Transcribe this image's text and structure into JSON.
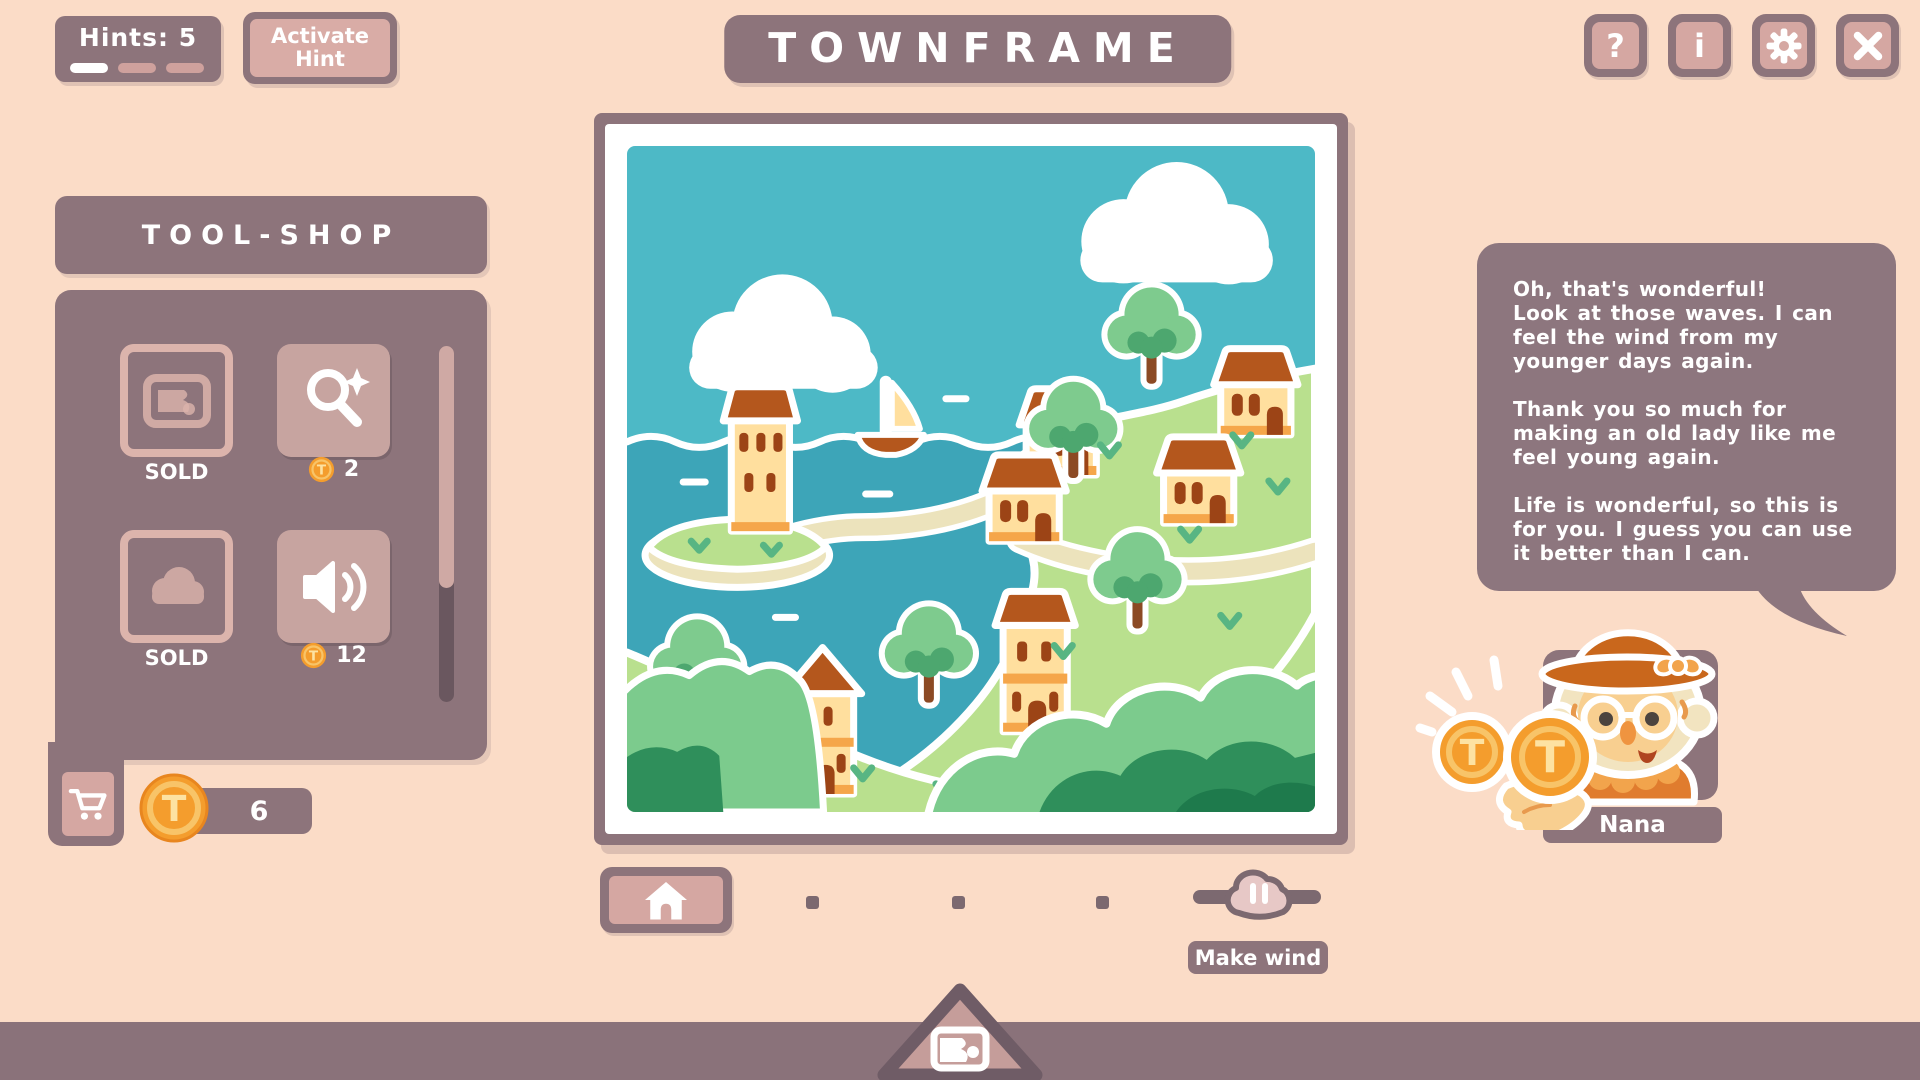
{
  "header": {
    "hints_label": "Hints: 5",
    "hint_meter": {
      "total": 3,
      "filled": 1
    },
    "activate_hint_label": "Activate Hint",
    "title": "TOWNFRAME",
    "help_glyph": "?",
    "info_glyph": "i"
  },
  "shop": {
    "title": "TOOL-SHOP",
    "currency_glyph": "T",
    "items": [
      {
        "id": "picture",
        "status": "SOLD"
      },
      {
        "id": "magnifier",
        "price": "2"
      },
      {
        "id": "cloud",
        "status": "SOLD"
      },
      {
        "id": "speaker",
        "price": "12"
      }
    ],
    "coin_balance": "6"
  },
  "controls": {
    "make_wind_label": "Make wind"
  },
  "dialogue": {
    "speaker": "Nana",
    "paragraphs": [
      "Oh, that's wonderful!\nLook at those waves. I can feel the wind from my younger days again.",
      "Thank you so much for making an old lady like me feel young again.",
      "Life is wonderful, so this is for you. I guess you can use it better than I can."
    ]
  },
  "colors": {
    "background": "#fbdcc7",
    "panel": "#8d747b",
    "button_fill": "#d5a7a2",
    "coin_orange": "#f49d2d",
    "sky": "#4db9c6",
    "sea": "#3da5b8",
    "grass": "#b9e08e",
    "roof": "#b4571d"
  }
}
